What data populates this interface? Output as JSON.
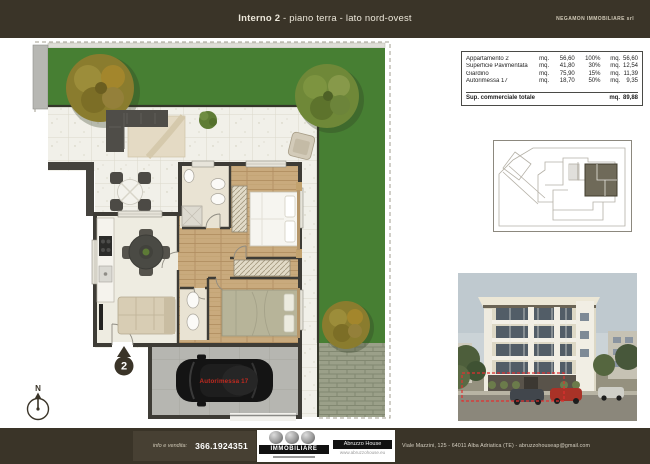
{
  "colors": {
    "page_band": "#3a3428",
    "panel_bg": "#ffffff",
    "garden_green": "#477f33",
    "accent_red": "#c22a20",
    "site_highlight": "#6f6a59"
  },
  "header": {
    "title_main": "Interno 2",
    "title_sub": " - piano terra - lato nord-ovest",
    "agency": "NEGAMON IMMOBILIARE srl"
  },
  "summary_table": {
    "rows": [
      {
        "label": "Appartamento 2",
        "unit1": "mq.",
        "value1": "56,60",
        "pct": "100%",
        "unit2": "mq.",
        "value2": "56,60"
      },
      {
        "label": "Superficie Pavimentata",
        "unit1": "mq.",
        "value1": "41,80",
        "pct": "30%",
        "unit2": "mq.",
        "value2": "12,54"
      },
      {
        "label": "Giardino",
        "unit1": "mq.",
        "value1": "75,90",
        "pct": "15%",
        "unit2": "mq.",
        "value2": "11,39"
      },
      {
        "label": "Autorimessa 17",
        "unit1": "mq.",
        "value1": "18,70",
        "pct": "50%",
        "unit2": "mq.",
        "value2": "9,35"
      }
    ],
    "total": {
      "label": "Sup. commerciale totale",
      "unit": "mq.",
      "value": "89,88"
    }
  },
  "floor_plan": {
    "unit_number": "2",
    "garage_label": "Autorimessa 17",
    "north_label": "N"
  },
  "footer": {
    "info_label": "info e vendita:",
    "phone": "366.1924351",
    "logo_text": "IMMOBILIARE",
    "brand_name": "Abruzzo House",
    "brand_site": "www.abruzzohouse.eu",
    "address": "Viale Mazzini, 125 - 64011 Alba Adriatica (TE) - abruzzohouseap@gmail.com"
  }
}
